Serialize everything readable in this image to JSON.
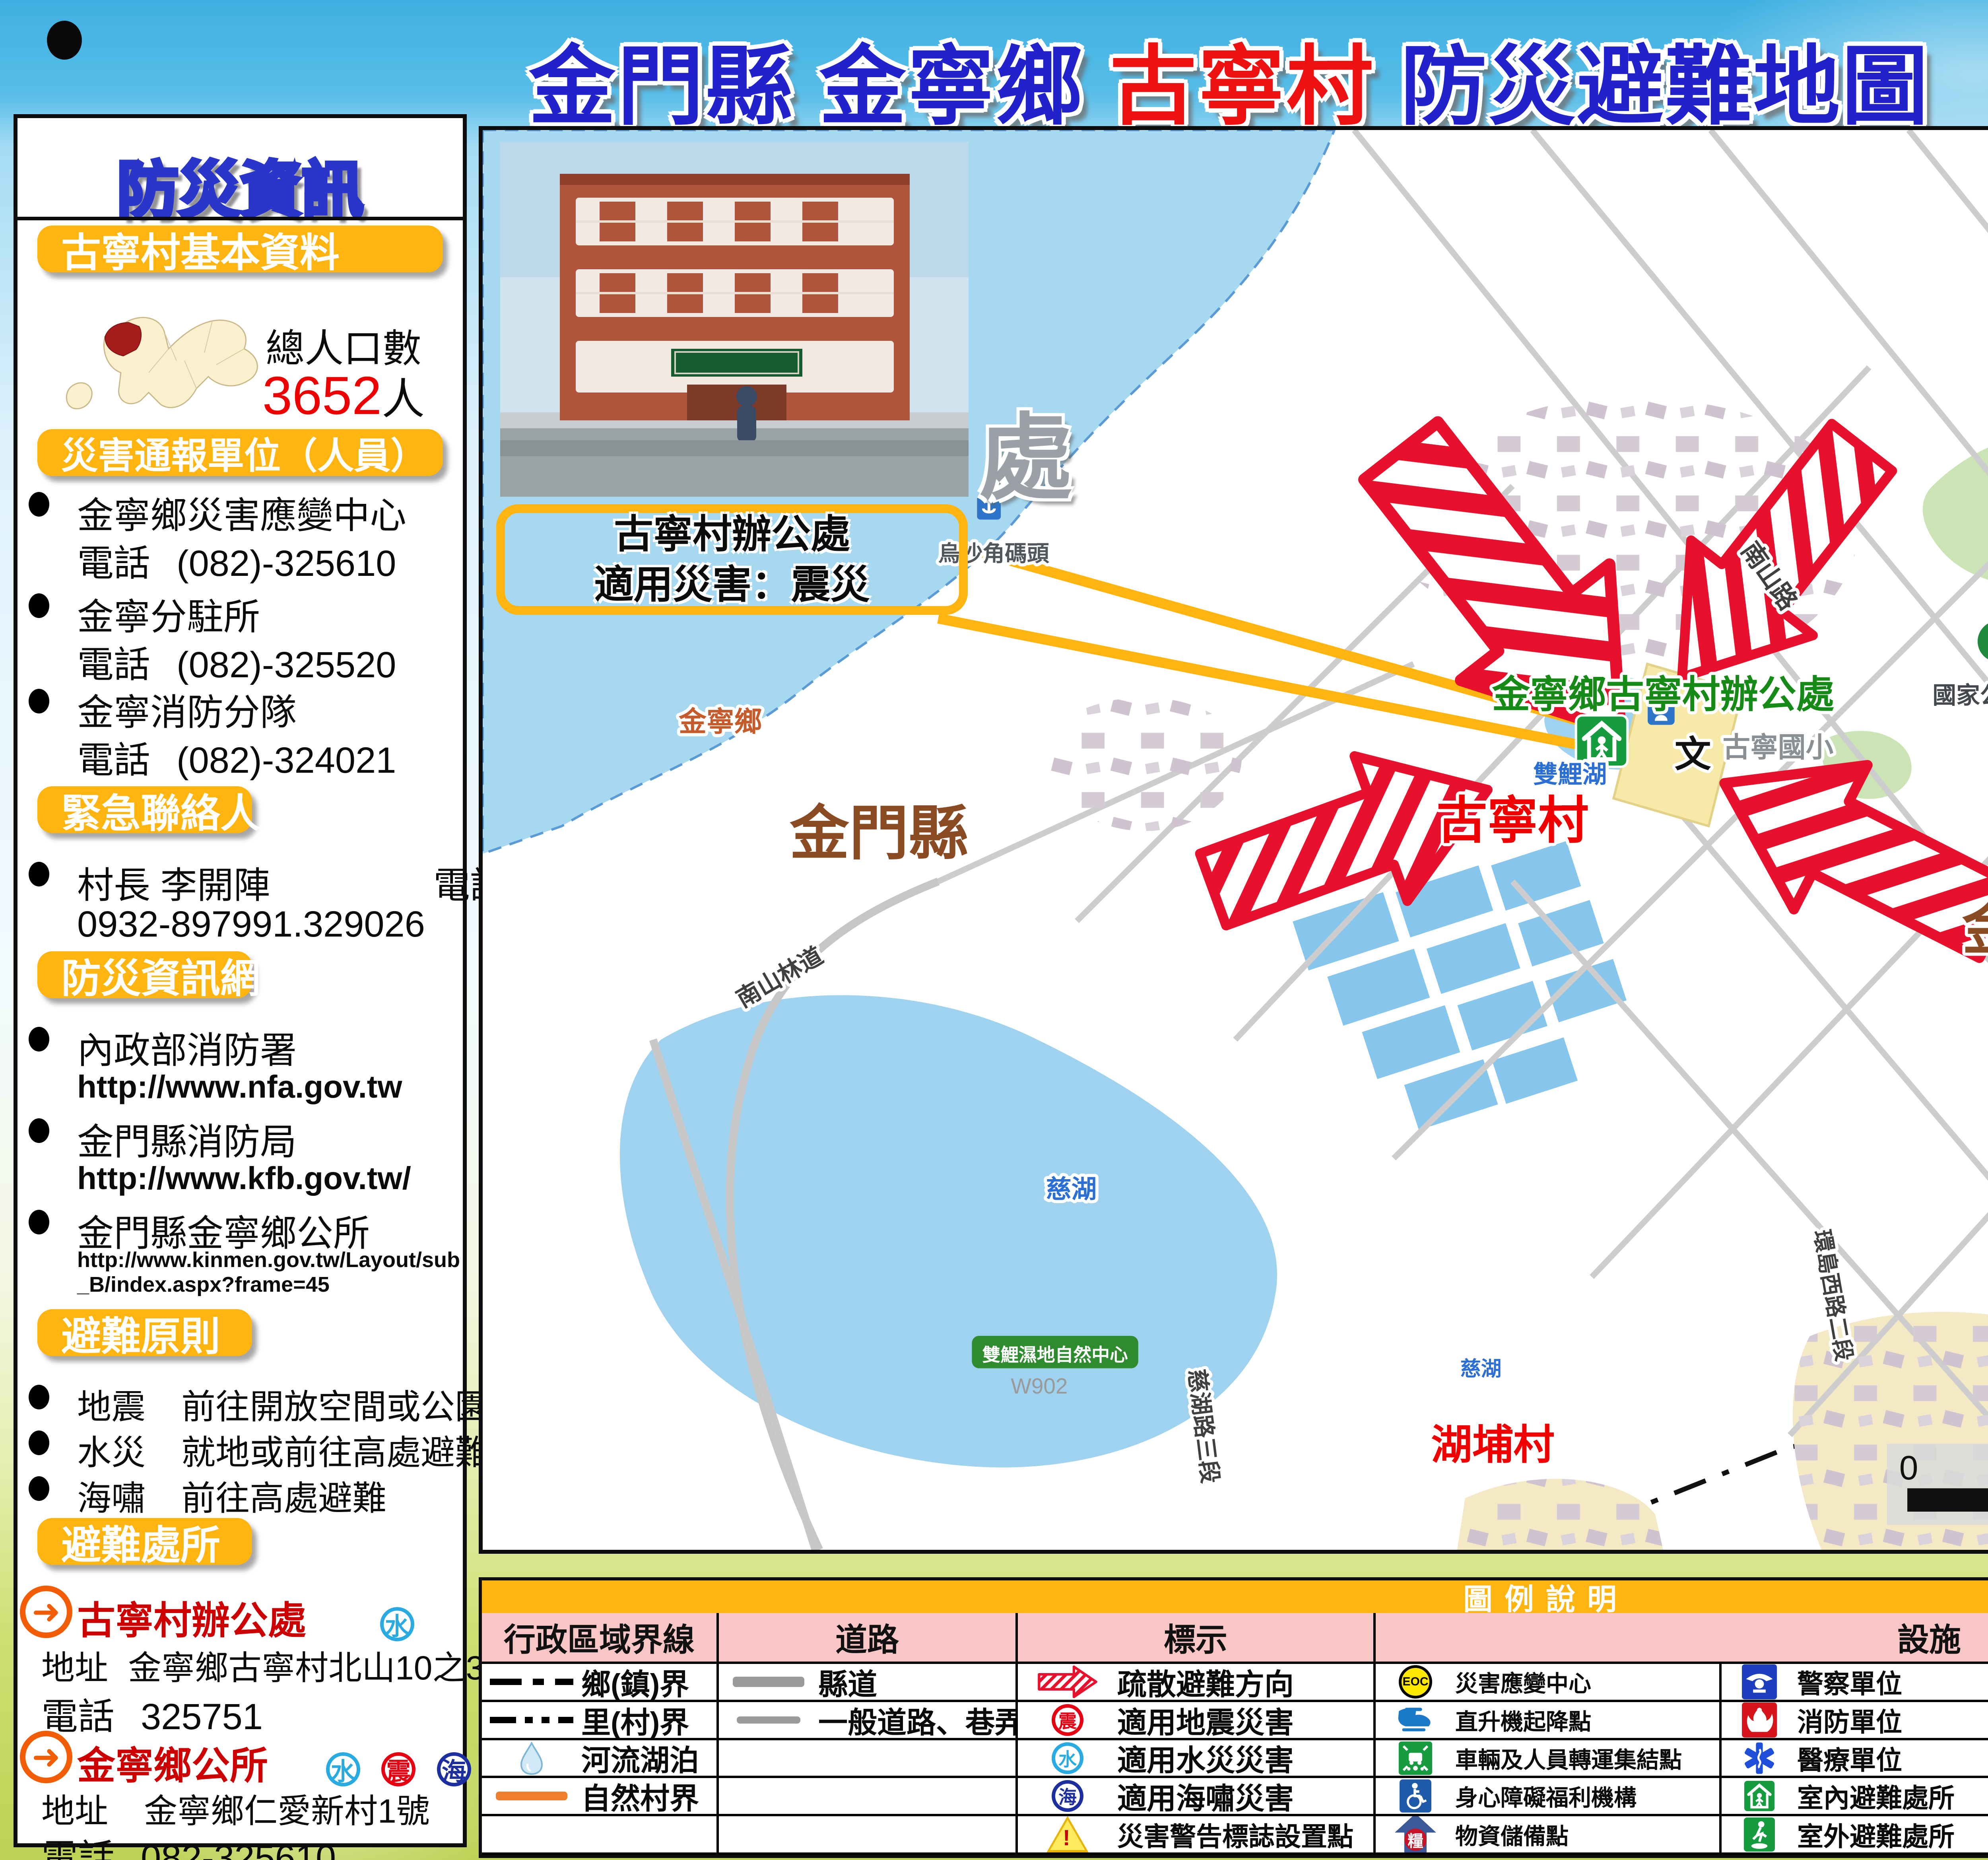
{
  "header": {
    "title": {
      "part1": "金門縣 ",
      "part2": "金寧鄉 ",
      "part3": "古寧村 ",
      "part4": "防災避難地圖"
    },
    "code": "編號 0902004-001"
  },
  "colors": {
    "accent_yellow": "#FFB410",
    "header_blue": "#3FB0E2",
    "title_blue": "#2222CC",
    "title_red": "#EE1111",
    "sea": "#A6D8F0",
    "legend_pink": "#F9C6C6",
    "evac_red": "#E8112D"
  },
  "sidebar": {
    "title": "防災資訊",
    "basic": {
      "heading": "古寧村基本資料",
      "population_label": "總人口數",
      "population_value": "3652",
      "population_unit": "人"
    },
    "report_units": {
      "heading": "災害通報單位（人員）",
      "items": [
        {
          "name": "金寧鄉災害應變中心",
          "phone_label": "電話",
          "phone": "(082)-325610"
        },
        {
          "name": "金寧分駐所",
          "phone_label": "電話",
          "phone": "(082)-325520"
        },
        {
          "name": "金寧消防分隊",
          "phone_label": "電話",
          "phone": "(082)-324021"
        }
      ]
    },
    "emergency_contact": {
      "heading": "緊急聯絡人",
      "name": "村長 李開陣",
      "phone_label": "電話",
      "phone": "0932-897991.329026"
    },
    "info_web": {
      "heading": "防災資訊網",
      "items": [
        {
          "name": "內政部消防署",
          "url": "http://www.nfa.gov.tw"
        },
        {
          "name": "金門縣消防局",
          "url": "http://www.kfb.gov.tw/"
        },
        {
          "name": "金門縣金寧鄉公所",
          "url": "http://www.kinmen.gov.tw/Layout/sub_B/index.aspx?frame=45"
        }
      ]
    },
    "principles": {
      "heading": "避難原則",
      "items": [
        {
          "type": "地震",
          "action": "前往開放空間或公園避難"
        },
        {
          "type": "水災",
          "action": "就地或前往高處避難"
        },
        {
          "type": "海嘯",
          "action": "前往高處避難"
        }
      ]
    },
    "shelters": {
      "heading": "避難處所",
      "items": [
        {
          "name": "古寧村辦公處",
          "badges": [
            "水"
          ],
          "address_label": "地址",
          "address": "金寧鄉古寧村北山10之3號",
          "phone_label": "電話",
          "phone": "325751"
        },
        {
          "name": "金寧鄉公所",
          "badges": [
            "水",
            "震",
            "海"
          ],
          "address_label": "地址",
          "address": "金寧鄉仁愛新村1號",
          "phone_label": "電話",
          "phone": "082-325610"
        }
      ]
    },
    "footer": "金門縣消防局113年7月 繪製"
  },
  "map": {
    "callout": {
      "line1": "古寧村辦公處",
      "line2": "適用災害：震災"
    },
    "hidden_char": "處",
    "compass": "N",
    "school_mark": "文",
    "place_labels": {
      "office_main": "金寧鄉古寧村辦公處",
      "village_main": "古寧村",
      "township_left": "金寧鄉",
      "township_right": "金寧鄉",
      "county_left": "金門縣",
      "county_right": "金門縣",
      "village_anmei": "安美村",
      "village_hupu": "湖埔村",
      "office_anmei": "金寧鄉安美村辦公處",
      "lake_shuangli": "雙鯉湖",
      "lake_cihu_a": "慈湖",
      "lake_cihu_b": "慈湖",
      "pier": "烏沙角碼頭",
      "school": "古寧國小",
      "battle_plaza_1": "古寧頭戰史館廣場",
      "battle_plaza_2": "(英勇戰士銅像)",
      "national_park": "國家公園古寧頭",
      "wetland": "雙鯉濕地自然中心",
      "road_nanshan": "南山路",
      "road_nanshan_trail": "南山林道",
      "road_cihu3": "慈湖路三段",
      "road_dinglin": "頂林路",
      "road_ring_west": "環島西路二段",
      "grid_wx33": "WX33",
      "grid_w902": "W902"
    },
    "scalebar": {
      "t0": "0",
      "t1": "400",
      "t2": "800",
      "t3": "1,600",
      "unit": "公尺"
    }
  },
  "legend": {
    "title": "圖例說明",
    "headers": {
      "admin": "行政區域界線",
      "roads": "道路",
      "marks": "標示",
      "facilities": "設施"
    },
    "side_label": "便利商店",
    "admin": [
      {
        "label": "鄉(鎮)界",
        "icon": "dash-dot-line"
      },
      {
        "label": "里(村)界",
        "icon": "dash-dot-dot-line"
      },
      {
        "label": "河流湖泊",
        "icon": "water-drop"
      },
      {
        "label": "自然村界",
        "icon": "orange-line"
      }
    ],
    "roads": [
      {
        "label": "縣道",
        "icon": "thick-gray-line"
      },
      {
        "label": "一般道路、巷弄",
        "icon": "thin-gray-line"
      }
    ],
    "marks": [
      {
        "label": "疏散避難方向",
        "icon": "striped-arrow"
      },
      {
        "label": "適用地震災害",
        "icon": "quake-badge",
        "badge": "震"
      },
      {
        "label": "適用水災災害",
        "icon": "flood-badge",
        "badge": "水"
      },
      {
        "label": "適用海嘯災害",
        "icon": "tsunami-badge",
        "badge": "海"
      },
      {
        "label": "災害警告標誌設置點",
        "icon": "warning-triangle",
        "badge": "!"
      }
    ],
    "facilities_col1": [
      {
        "label": "災害應變中心",
        "icon": "eoc",
        "badge": "EOC"
      },
      {
        "label": "直升機起降點",
        "icon": "heliport"
      },
      {
        "label": "車輛及人員轉運集結點",
        "icon": "assembly-point"
      },
      {
        "label": "身心障礙福利機構",
        "icon": "accessible"
      },
      {
        "label": "物資儲備點",
        "icon": "supplies",
        "badge": "糧"
      }
    ],
    "facilities_col2": [
      {
        "label": "警察單位",
        "icon": "police"
      },
      {
        "label": "消防單位",
        "icon": "fire"
      },
      {
        "label": "醫療單位",
        "icon": "medical"
      },
      {
        "label": "室內避難處所",
        "icon": "indoor-shelter"
      },
      {
        "label": "室外避難處所",
        "icon": "outdoor-shelter"
      }
    ],
    "facilities_col3": [
      {
        "label": "鄉鎮公所",
        "icon": "township-office",
        "badge": "公"
      },
      {
        "label": "里辦公處",
        "icon": "village-office",
        "badge": "里"
      },
      {
        "label": "學校",
        "icon": "school",
        "badge": "文"
      },
      {
        "label": "公園綠地",
        "icon": "park"
      },
      {
        "label": "郵局",
        "icon": "post-office",
        "badge": "郵"
      }
    ],
    "facilities_col4": [
      {
        "label": "衛生單位",
        "icon": "health",
        "badge": "衛"
      },
      {
        "label": "地標",
        "icon": "landmark-flower"
      },
      {
        "label": "中華電信",
        "icon": "telecom"
      },
      {
        "label": "加油站",
        "icon": "gas-station"
      }
    ],
    "stores": {
      "seven": "7",
      "eleven": "ELEVEn",
      "hilife": "Hi-Life"
    }
  }
}
